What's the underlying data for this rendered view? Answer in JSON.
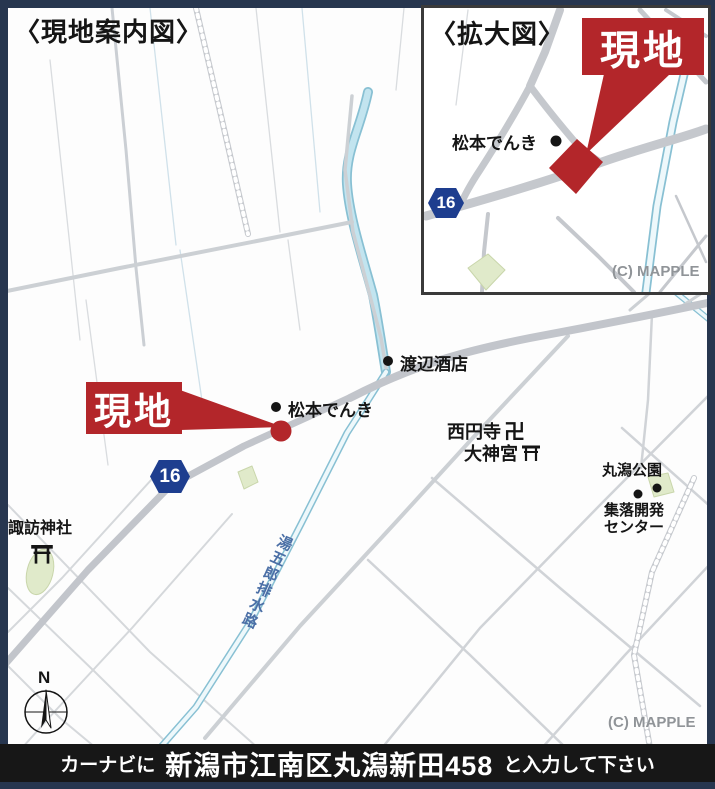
{
  "titles": {
    "main": "〈現地案内図〉",
    "inset": "〈拡大図〉"
  },
  "site": {
    "label": "現地",
    "color": "#b3262a"
  },
  "route": {
    "number": "16",
    "color": "#1e3e8f"
  },
  "places": {
    "matsumoto": "松本でんき",
    "watanabe": "渡辺酒店",
    "saienji": "西円寺",
    "manji_icon": "卍",
    "daijingu": "大神宮",
    "marugata_park": "丸潟公園",
    "shuraku_kaihatsu_line1": "集落開発",
    "shuraku_kaihatsu_line2": "センター",
    "suwa_shrine": "諏訪神社",
    "canal_name": "湯五郎排水路"
  },
  "compass": {
    "north": "N"
  },
  "credits": {
    "mapple": "(C) MAPPLE"
  },
  "bottom_bar": {
    "prefix": "カーナビに",
    "address": "新潟市江南区丸潟新田458",
    "suffix": "と入力して下さい"
  },
  "colors": {
    "site_red": "#b3262a",
    "route_blue": "#1e3e8f",
    "river_blue": "#a8d8e8",
    "canal_text": "#4b6fa6",
    "frame_navy": "#27364f",
    "bar_black": "#171717",
    "road_gray": "#c2c5cb",
    "credit_gray": "#909498"
  }
}
